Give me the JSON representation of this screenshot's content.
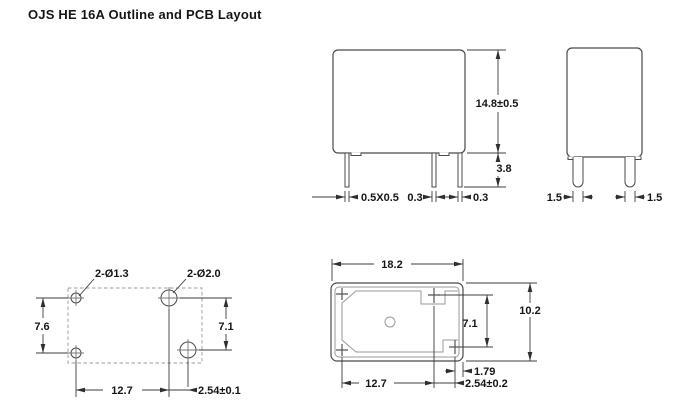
{
  "title": "OJS HE 16A Outline and PCB Layout",
  "front_view": {
    "height": "14.8±0.5",
    "pin_length": "3.8",
    "pin_left": "0.5X0.5",
    "pin_mid": "0.3",
    "pin_right": "0.3"
  },
  "side_view": {
    "pin_left": "1.5",
    "pin_right": "1.5"
  },
  "pcb_layout": {
    "small_holes": "2-Ø1.3",
    "large_holes": "2-Ø2.0",
    "left_pitch": "7.6",
    "right_pitch": "7.1",
    "pitch": "12.7",
    "offset": "2.54±0.1"
  },
  "bottom_view": {
    "width": "18.2",
    "depth": "10.2",
    "right_pitch": "7.1",
    "edge_offset": "1.79",
    "pitch": "12.7",
    "offset": "2.54±0.2"
  },
  "colors": {
    "line": "#4a4a4a",
    "dim_line": "#3c3c3c",
    "light_line": "#9a9a9a",
    "text": "#161616",
    "background": "#ffffff"
  }
}
